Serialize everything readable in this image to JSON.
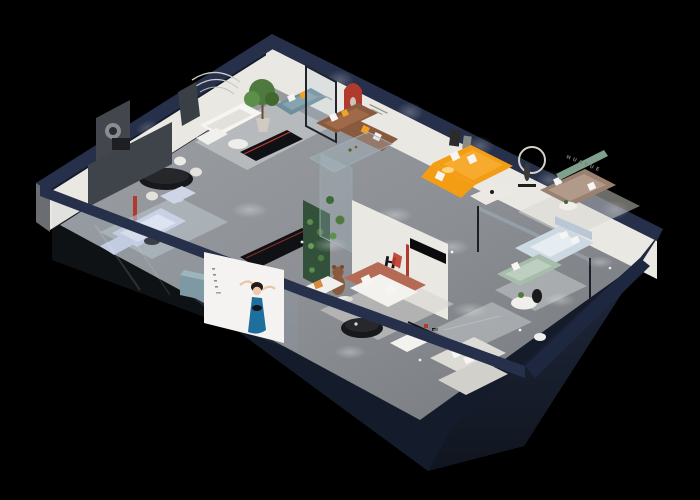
{
  "scene": {
    "title": "3D cutaway isometric render of HUAYUE furniture showroom apartment",
    "brand": {
      "monogram": "H",
      "name_cn": "华悦",
      "name_en": "HUAYUE"
    },
    "billboard": {
      "poster_subject": "woman in blue dress"
    }
  },
  "colors": {
    "background": "#000000",
    "wall_band": "#26304a",
    "wall_outer": "#141b2a",
    "wall_face_right": "#1b2335",
    "wall_white": "#eae8e3",
    "wall_white_shade": "#dcd9d3",
    "wall_dark_accent": "#43464c",
    "floor": "#8d9095",
    "floor_light": "#a3a6aa",
    "accent_red": "#b03a2e",
    "sofa_teal": "#6f8f9c",
    "sofa_brown": "#8a5a3e",
    "sofa_orange": "#f29d13",
    "sofa_taupe": "#9a8071",
    "sofa_terracotta": "#b56a55",
    "sofa_sage": "#a6bdab",
    "sofa_periwinkle": "#c7d0e4",
    "bed_blue": "#cdd9e2",
    "pillow_orange": "#f0a227",
    "pillow_white": "#f6f5f2",
    "plant_green": "#4e7a3f",
    "garden_wall_green": "#32503a",
    "shelf_green": "#7fa08c",
    "dress_blue": "#1f6f9e",
    "bear_brown": "#8b5a3c",
    "table_black": "#17181b",
    "console_black": "#101114",
    "rug_light": "#d5d3cf",
    "billboard_white": "#f4f3f1"
  }
}
